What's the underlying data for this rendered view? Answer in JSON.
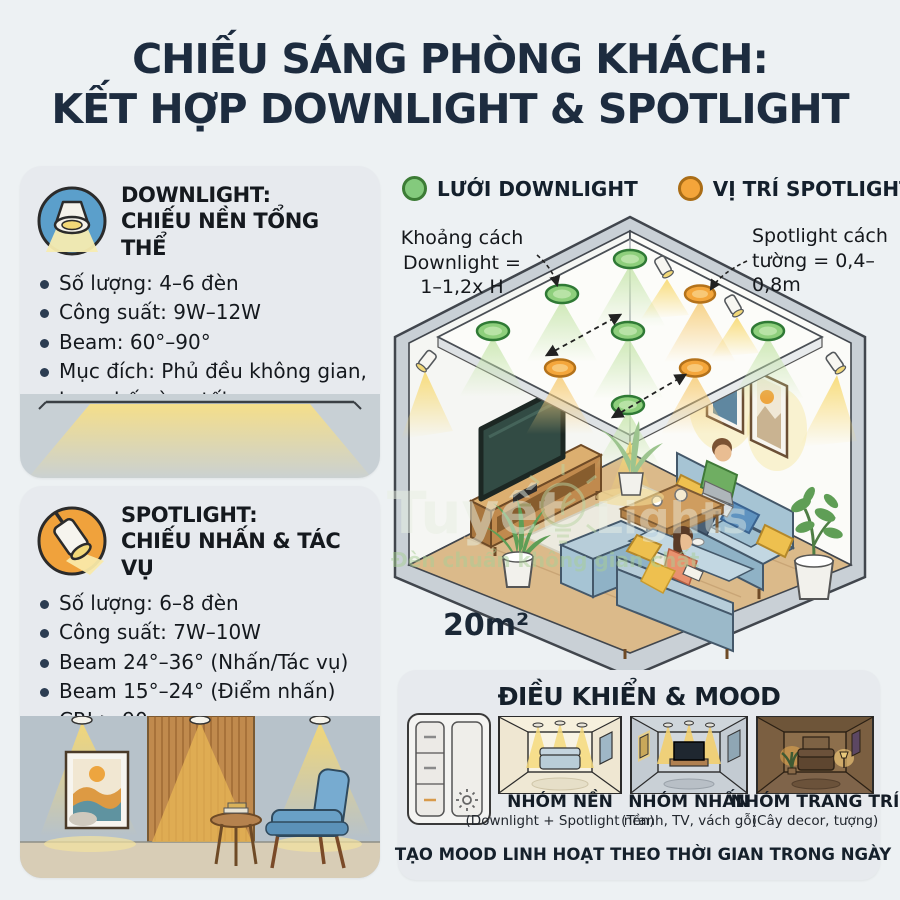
{
  "title": {
    "line1": "CHIẾU SÁNG PHÒNG KHÁCH:",
    "line2": "KẾT HỢP DOWNLIGHT & SPOTLIGHT"
  },
  "downlight_panel": {
    "title_line1": "DOWNLIGHT:",
    "title_line2": "CHIẾU NỀN TỔNG THỂ",
    "bullets": [
      "Số lượng: 4–6 đèn",
      "Công suất: 9W–12W",
      "Beam: 60°–90°",
      "Mục đích: Phủ đều không gian, hạn chế vùng tối"
    ]
  },
  "spotlight_panel": {
    "title_line1": "SPOTLIGHT:",
    "title_line2": "CHIẾU NHẤN & TÁC VỤ",
    "bullets": [
      "Số lượng: 6–8 đèn",
      "Công suất: 7W–10W",
      "Beam 24°–36° (Nhấn/Tác vụ)",
      "Beam 15°–24° (Điểm nhấn)",
      "CRI > 90"
    ]
  },
  "legend": {
    "downlight_label": "LƯỚI DOWNLIGHT",
    "spotlight_label": "VỊ TRÍ SPOTLIGHT"
  },
  "diagram": {
    "annotation_left": {
      "line1": "Khoảng cách",
      "line2": "Downlight =",
      "line3": "1–1,2x H"
    },
    "annotation_right": {
      "line1": "Spotlight cách",
      "line2": "tường = 0,4–",
      "line3": "0,8m"
    },
    "area_label": "20m²"
  },
  "watermark": {
    "brand": "Tuyết",
    "brand2": "Lights",
    "slogan": "Đèn chuẩn không gian chất"
  },
  "mood_panel": {
    "title": "ĐIỀU KHIỂN & MOOD",
    "groups": [
      {
        "label": "NHÓM NỀN",
        "sub": "(Downlight + Spotlight nền)"
      },
      {
        "label": "NHÓM NHẤN",
        "sub": "(Tranh, TV, vách gỗ)"
      },
      {
        "label": "NHÓM TRANG TRÍ",
        "sub": "(Cây decor, tượng)"
      }
    ],
    "footer": "TẠO MOOD LINH HOẠT THEO THỜI GIAN TRONG NGÀY"
  },
  "colors": {
    "navy": "#1d2c3f",
    "downlight_green": "#84ca7d",
    "spotlight_orange": "#f4a53a",
    "beam_yellow": "#f8d96f",
    "panel_bg": "#e7eaee",
    "page_bg": "#edf1f3"
  }
}
